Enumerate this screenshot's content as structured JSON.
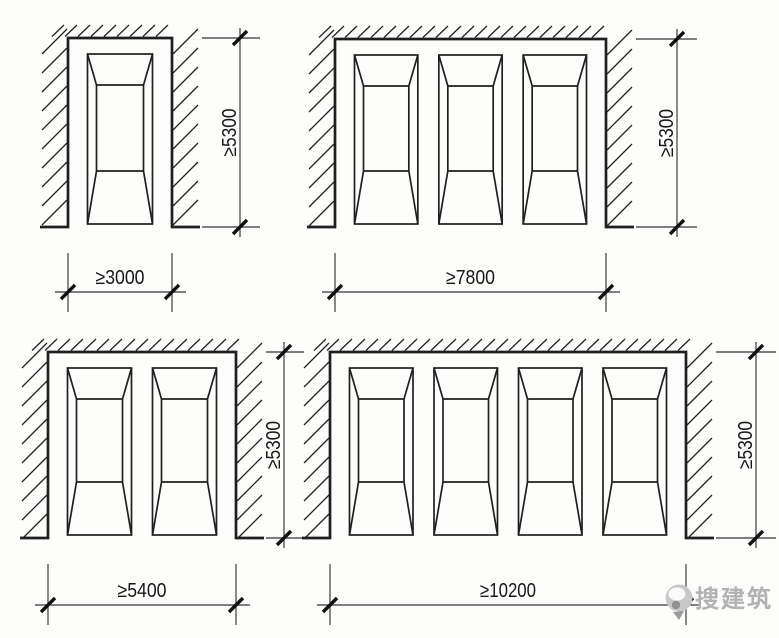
{
  "canvas": {
    "width": 779,
    "height": 633,
    "background": "#fdfdfc",
    "ink": "#1f1f1f",
    "dim_ink": "#343434",
    "text_ink": "#171717"
  },
  "watermark": {
    "text": "搜建筑",
    "color": "#b2b2b2"
  },
  "style": {
    "margin": 19.5,
    "gap": 21,
    "foot": 28,
    "sym_top": 16,
    "sym_bottom": 3,
    "inset": 9,
    "trap_top": 31,
    "trap_bottom": 53
  },
  "diagrams": [
    {
      "id": "bay-1-space",
      "spaces": 1,
      "width_label": "≥3000",
      "height_label": "≥5300",
      "layout": {
        "left": 68,
        "top": 38,
        "right": 172,
        "bottom": 227,
        "vdim_x": 240,
        "hdim_y": 292
      }
    },
    {
      "id": "bay-3-space",
      "spaces": 3,
      "width_label": "≥7800",
      "height_label": "≥5300",
      "layout": {
        "left": 335,
        "top": 39,
        "right": 606,
        "bottom": 227,
        "vdim_x": 677,
        "hdim_y": 292
      }
    },
    {
      "id": "bay-2-space",
      "spaces": 2,
      "width_label": "≥5400",
      "height_label": "≥5300",
      "layout": {
        "left": 48,
        "top": 352,
        "right": 236,
        "bottom": 538,
        "vdim_x": 284,
        "hdim_y": 605
      }
    },
    {
      "id": "bay-4-space",
      "spaces": 4,
      "width_label": "≥10200",
      "height_label": "≥5300",
      "layout": {
        "left": 330,
        "top": 352,
        "right": 686,
        "bottom": 538,
        "vdim_x": 756,
        "hdim_y": 605
      }
    }
  ]
}
